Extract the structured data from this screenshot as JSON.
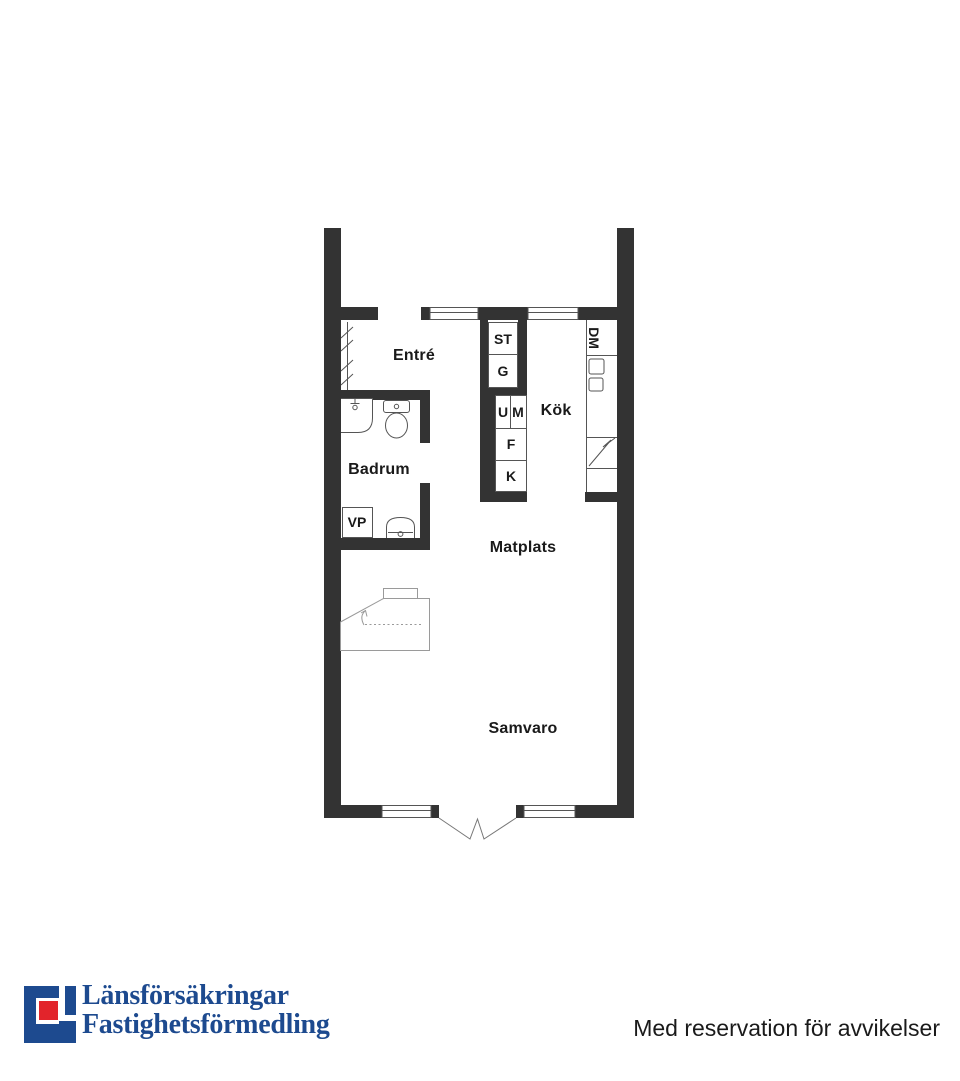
{
  "plan": {
    "rooms": {
      "entre": "Entré",
      "badrum": "Badrum",
      "kok": "Kök",
      "matplats": "Matplats",
      "samvaro": "Samvaro"
    },
    "fixtures": {
      "st": "ST",
      "g": "G",
      "u": "U",
      "m": "M",
      "f": "F",
      "k": "K",
      "dm": "DM",
      "vp": "VP"
    }
  },
  "footer": {
    "logo_line1": "Länsförsäkringar",
    "logo_line2": "Fastighetsförmedling",
    "disclaimer": "Med reservation för avvikelser"
  },
  "colors": {
    "wall": "#333333",
    "line": "#555555",
    "furniture": "#9a9a9a",
    "label": "#1a1a1a",
    "logo_blue": "#1d4a8f",
    "logo_red": "#e2242b"
  }
}
